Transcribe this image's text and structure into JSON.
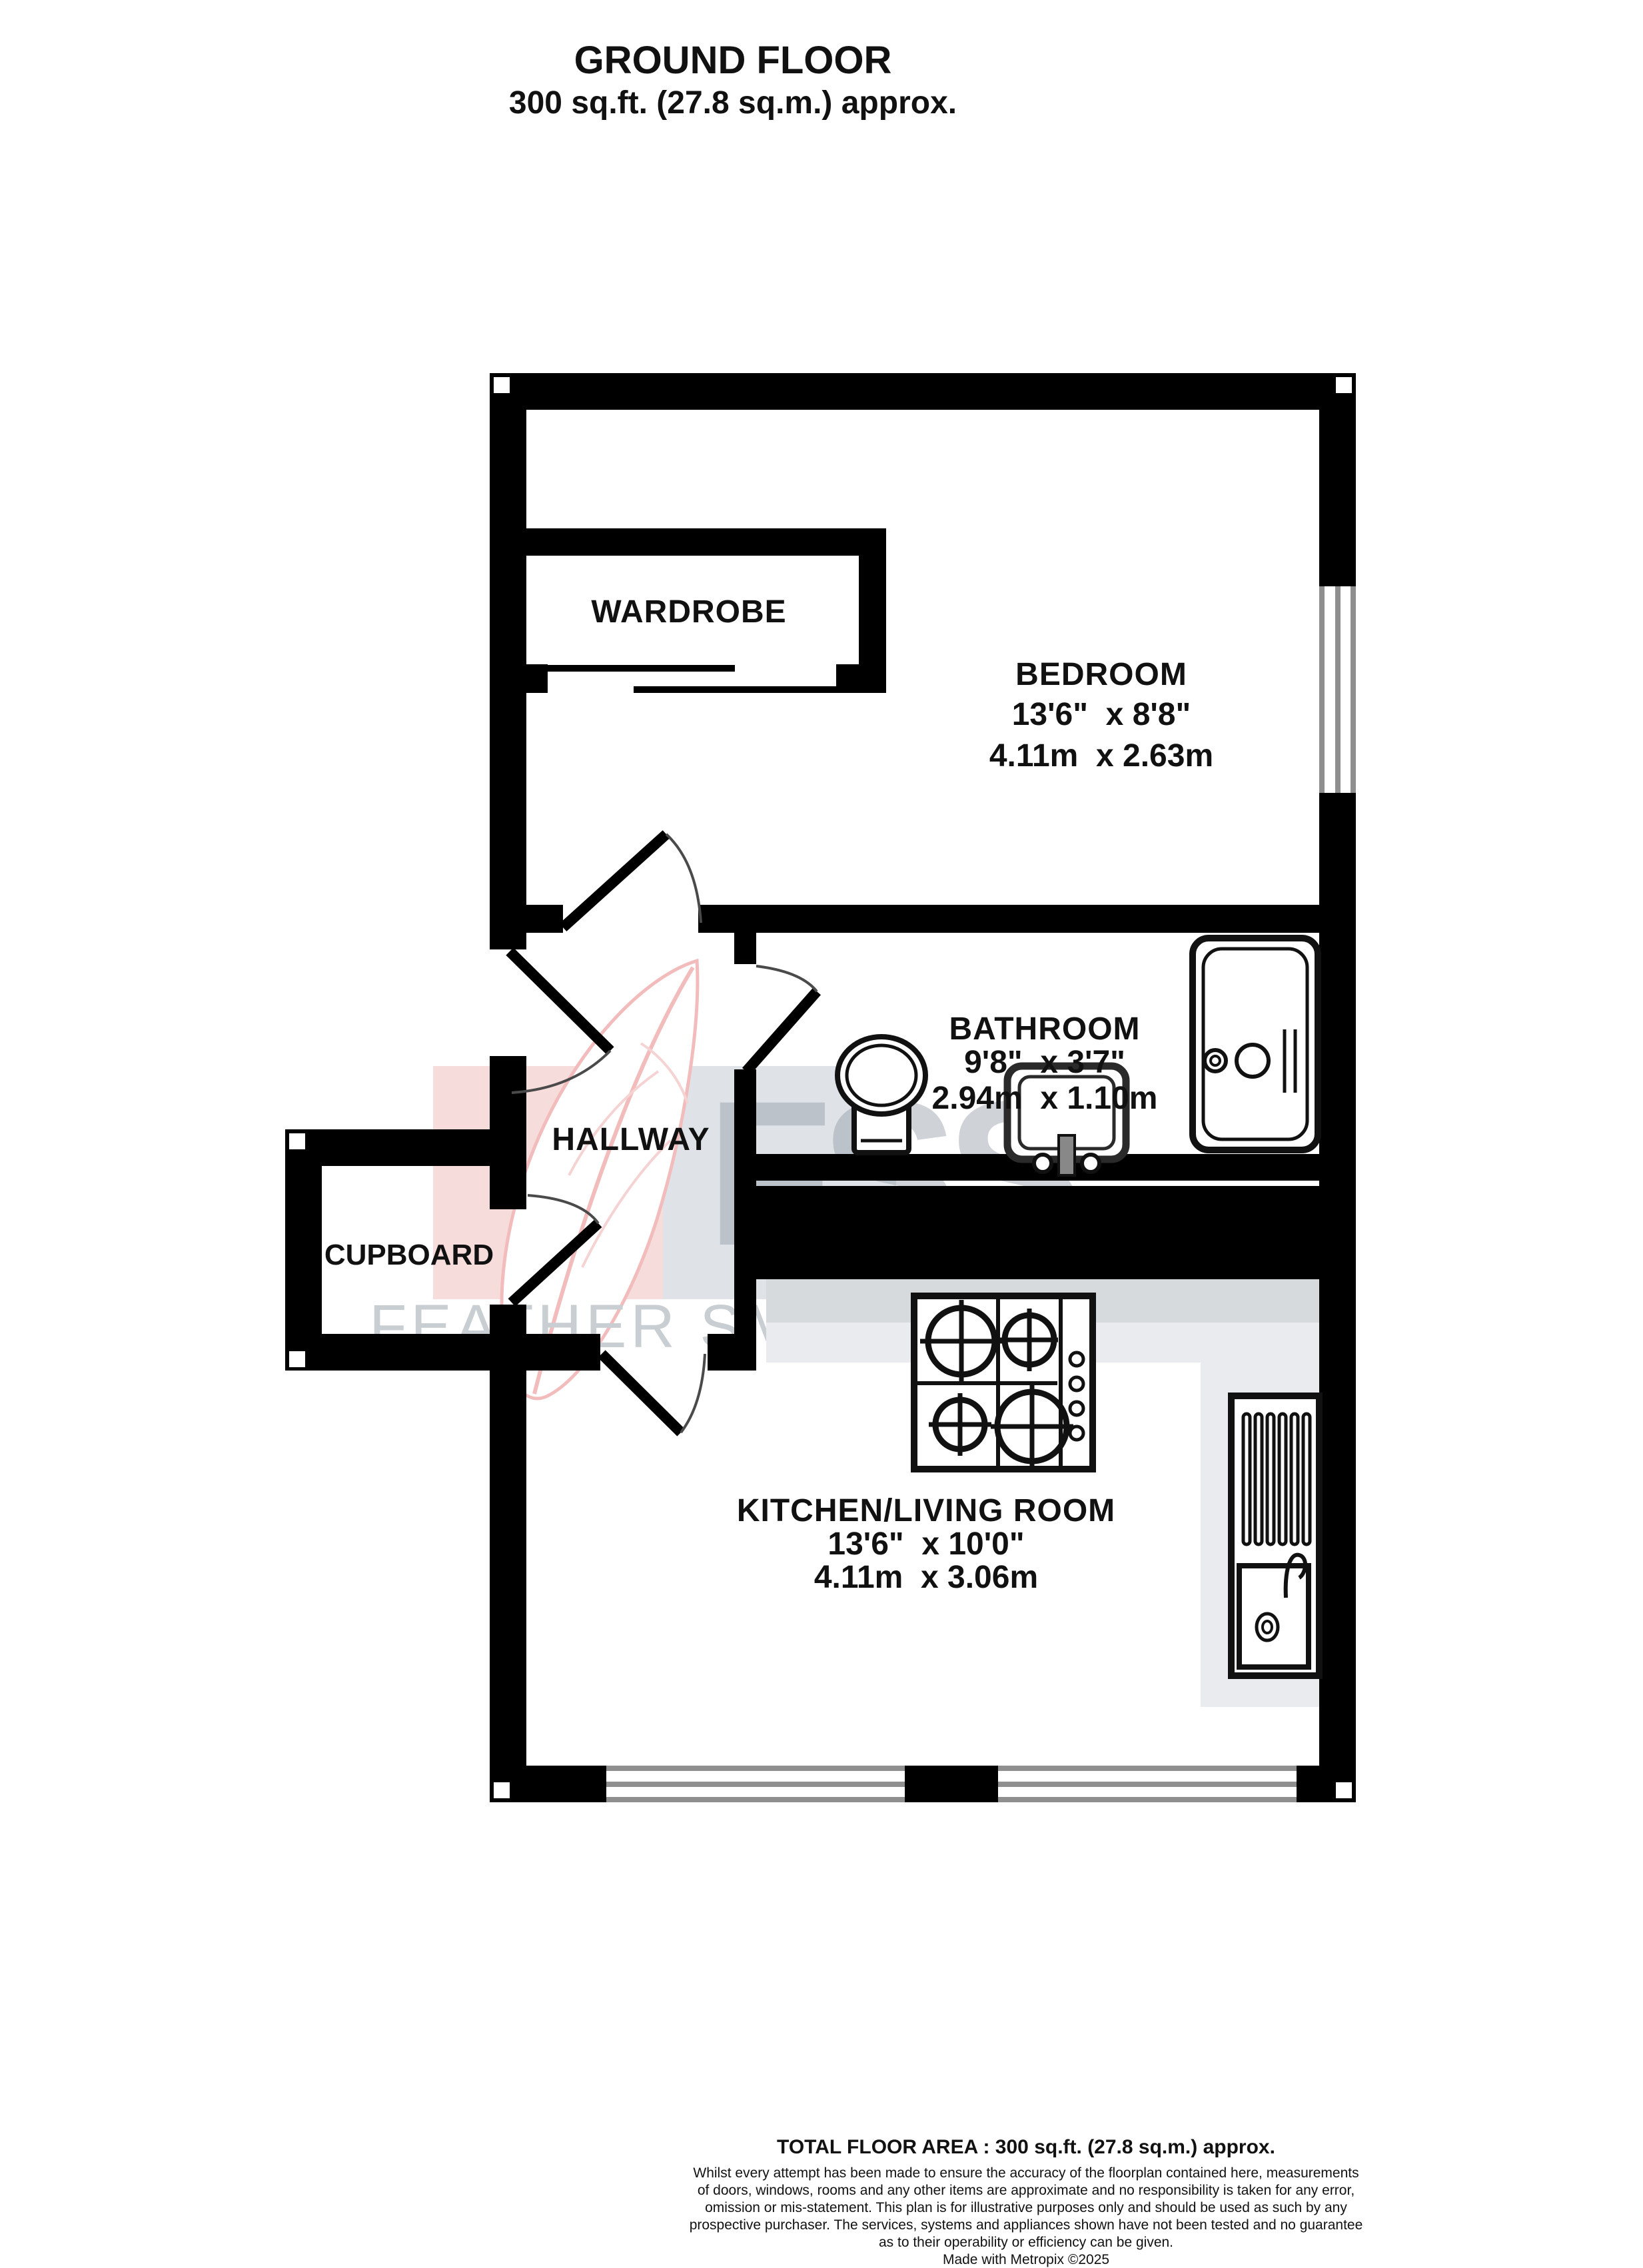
{
  "title": {
    "line1": "GROUND FLOOR",
    "line2": "300 sq.ft. (27.8 sq.m.) approx."
  },
  "rooms": {
    "wardrobe": {
      "name": "WARDROBE"
    },
    "bedroom": {
      "name": "BEDROOM",
      "imperial": "13'6\"  x 8'8\"",
      "metric": "4.11m  x 2.63m"
    },
    "bathroom": {
      "name": "BATHROOM",
      "imperial": "9'8\"  x 3'7\"",
      "metric": "2.94m  x 1.10m"
    },
    "hallway": {
      "name": "HALLWAY"
    },
    "cupboard": {
      "name": "CUPBOARD"
    },
    "kitchen": {
      "name": "KITCHEN/LIVING ROOM",
      "imperial": "13'6\"  x 10'0\"",
      "metric": "4.11m  x 3.06m"
    }
  },
  "watermark": {
    "monogram": "FSS",
    "text": "FEATHER SMAILES SCALES",
    "pink_square": "#f7dcdc",
    "gray_square": "#dfe3e7",
    "monogram_color": "#8e96a0",
    "text_color": "#c9ced3",
    "feather_outline": "#f2bcbc"
  },
  "colors": {
    "walls": "#000000",
    "counter_dark": "#d6dadd",
    "counter_light": "#e9ebee",
    "window_line": "#8f8f8f"
  },
  "footer": {
    "total": "TOTAL FLOOR AREA : 300 sq.ft. (27.8 sq.m.) approx.",
    "disclaimer": [
      "Whilst every attempt has been made to ensure the accuracy of the floorplan contained here, measurements",
      "of doors, windows, rooms and any other items are approximate and no responsibility is taken for any error,",
      "omission or mis-statement. This plan is for illustrative purposes only and should be used as such by any",
      "prospective purchaser. The services, systems and appliances shown have not been tested and no guarantee",
      "as to their operability or efficiency can be given."
    ],
    "credit": "Made with Metropix ©2025"
  }
}
